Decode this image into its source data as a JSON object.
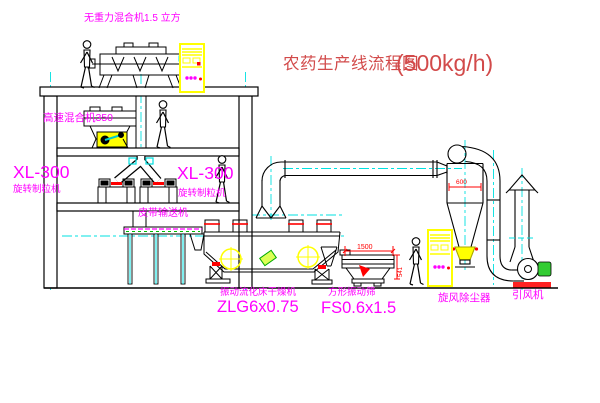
{
  "title": {
    "text": "农药生产线流程图",
    "capacity": "(500kg/h)"
  },
  "equipment": {
    "gravity_mixer": {
      "label": "无重力混合机1.5 立方"
    },
    "high_speed_mixer": {
      "label": "高速混合机350"
    },
    "granulator_left": {
      "model": "XL-300",
      "name": "旋转制粒机"
    },
    "granulator_right": {
      "model": "XL-300",
      "name": "旋转制粒机"
    },
    "belt_conveyor": {
      "label": "皮带输送机"
    },
    "fluid_bed_dryer": {
      "name": "振动流化床干燥机",
      "model": "ZLG6x0.75"
    },
    "vibrating_screen": {
      "name": "方形振动筛",
      "model": "FS0.6x1.5"
    },
    "cyclone": {
      "name": "旋风除尘器"
    },
    "induced_draft_fan": {
      "name": "引风机"
    }
  },
  "dimensions": {
    "screen_length": "1500",
    "screen_height": "541",
    "cyclone_diameter": "600"
  },
  "colors": {
    "label_magenta": "#ff00ff",
    "title_red": "#d24a4a",
    "dimension_red": "#ff0000",
    "centerline_cyan": "#00e0e0",
    "highlight_yellow": "#ffff00",
    "line_black": "#000000"
  }
}
